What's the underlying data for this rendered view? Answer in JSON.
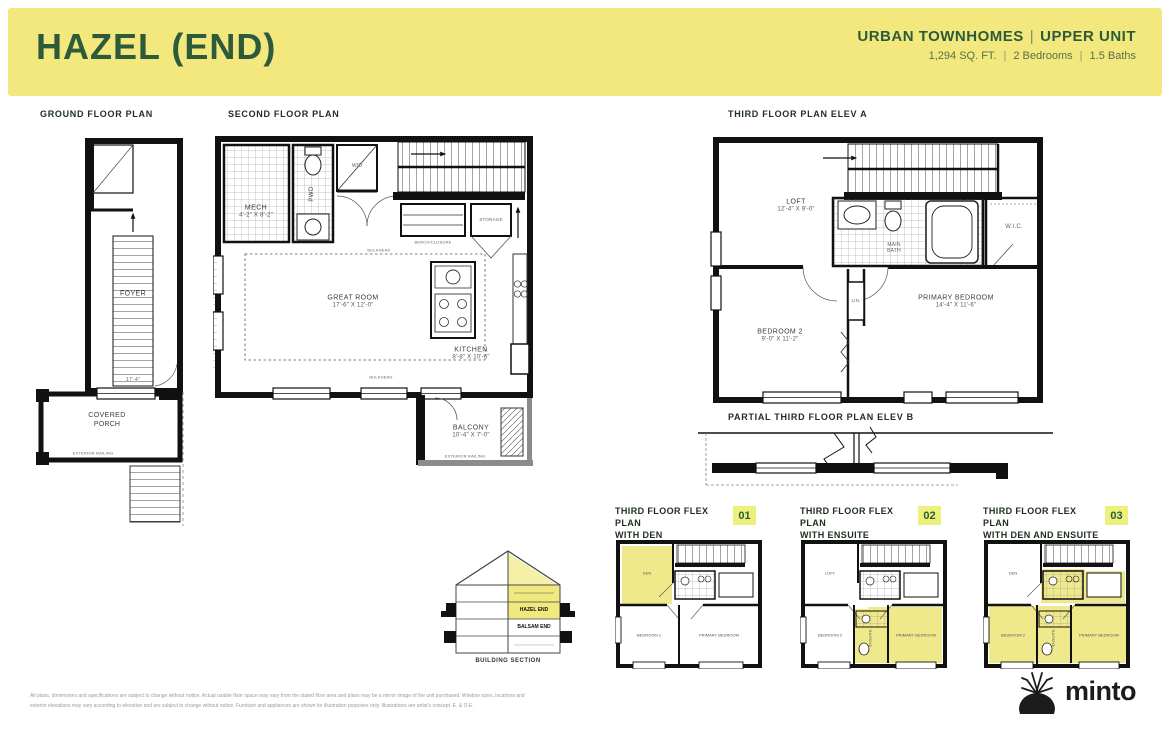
{
  "header": {
    "title": "HAZEL (END)",
    "category": "URBAN TOWNHOMES",
    "divider": "|",
    "unit": "UPPER UNIT",
    "sqft": "1,294 SQ. FT.",
    "bedrooms": "2 Bedrooms",
    "baths": "1.5 Baths",
    "band_color": "#f2e87d",
    "accent_green": "#2d5a3a"
  },
  "labels": {
    "ground": "GROUND FLOOR PLAN",
    "second": "SECOND FLOOR PLAN",
    "third_a": "THIRD FLOOR PLAN ELEV A",
    "third_b": "PARTIAL THIRD FLOOR PLAN ELEV B"
  },
  "ground": {
    "foyer": "FOYER",
    "stair_dim": "17'-4\"",
    "porch1": "COVERED",
    "porch2": "PORCH",
    "railing": "EXTERIOR RAILING"
  },
  "second": {
    "mech": "MECH",
    "mech_dims": "4'-2\" X 8'-2\"",
    "pwd": "PWD",
    "wd": "W/D",
    "storage": "STORAGE",
    "bench": "BENCH/CLOSURE",
    "bulkhead_top": "BULKHEAD",
    "bulkhead_bottom": "BULKHEAD",
    "great": "GREAT ROOM",
    "great_dims": "17'-6\" X 12'-0\"",
    "kitchen": "KITCHEN",
    "kitchen_dims": "8'-8\" X 10'-6\"",
    "balcony": "BALCONY",
    "balcony_dims": "10'-4\" X 7'-0\"",
    "ext_railing": "EXTERIOR RAILING"
  },
  "third": {
    "loft": "LOFT",
    "loft_dims": "12'-4\" X 9'-0\"",
    "bath1": "MAIN",
    "bath2": "BATH",
    "wic": "W.I.C.",
    "lin": "LIN.",
    "bed2": "BEDROOM 2",
    "bed2_dims": "9'-0\" X 11'-2\"",
    "primary": "PRIMARY BEDROOM",
    "primary_dims": "14'-4\" X 11'-6\""
  },
  "flex": {
    "plans": [
      {
        "line1": "THIRD FLOOR FLEX PLAN",
        "line2": "WITH DEN",
        "badge": "01",
        "rooms": {
          "den": "DEN",
          "bed2": "BEDROOM 2",
          "primary": "PRIMARY BEDROOM"
        }
      },
      {
        "line1": "THIRD FLOOR FLEX PLAN",
        "line2": "WITH ENSUITE",
        "badge": "02",
        "rooms": {
          "loft": "LOFT",
          "bed2": "BEDROOM 2",
          "ensuite": "ENSUITE",
          "primary": "PRIMARY BEDROOM"
        }
      },
      {
        "line1": "THIRD FLOOR FLEX PLAN",
        "line2": "WITH DEN AND ENSUITE",
        "badge": "03",
        "rooms": {
          "den": "DEN",
          "bed2": "BEDROOM 2",
          "ensuite": "ENSUITE",
          "primary": "PRIMARY BEDROOM"
        }
      }
    ],
    "highlight_color": "#efe98c"
  },
  "section": {
    "hazel": "HAZEL END",
    "balsam": "BALSAM END",
    "label": "BUILDING SECTION"
  },
  "footer": {
    "disclaimer": "All plans, dimensions and specifications are subject to change without notice. Actual usable floor space may vary from the stated floor area and plans may be a mirror image of the unit purchased. Window sizes, locations and exterior elevations may vary according to elevation and are subject to change without notice. Furniture and appliances are shown for illustration purposes only. Illustrations are artist's concept. E. & O.E.",
    "brand": "minto"
  }
}
